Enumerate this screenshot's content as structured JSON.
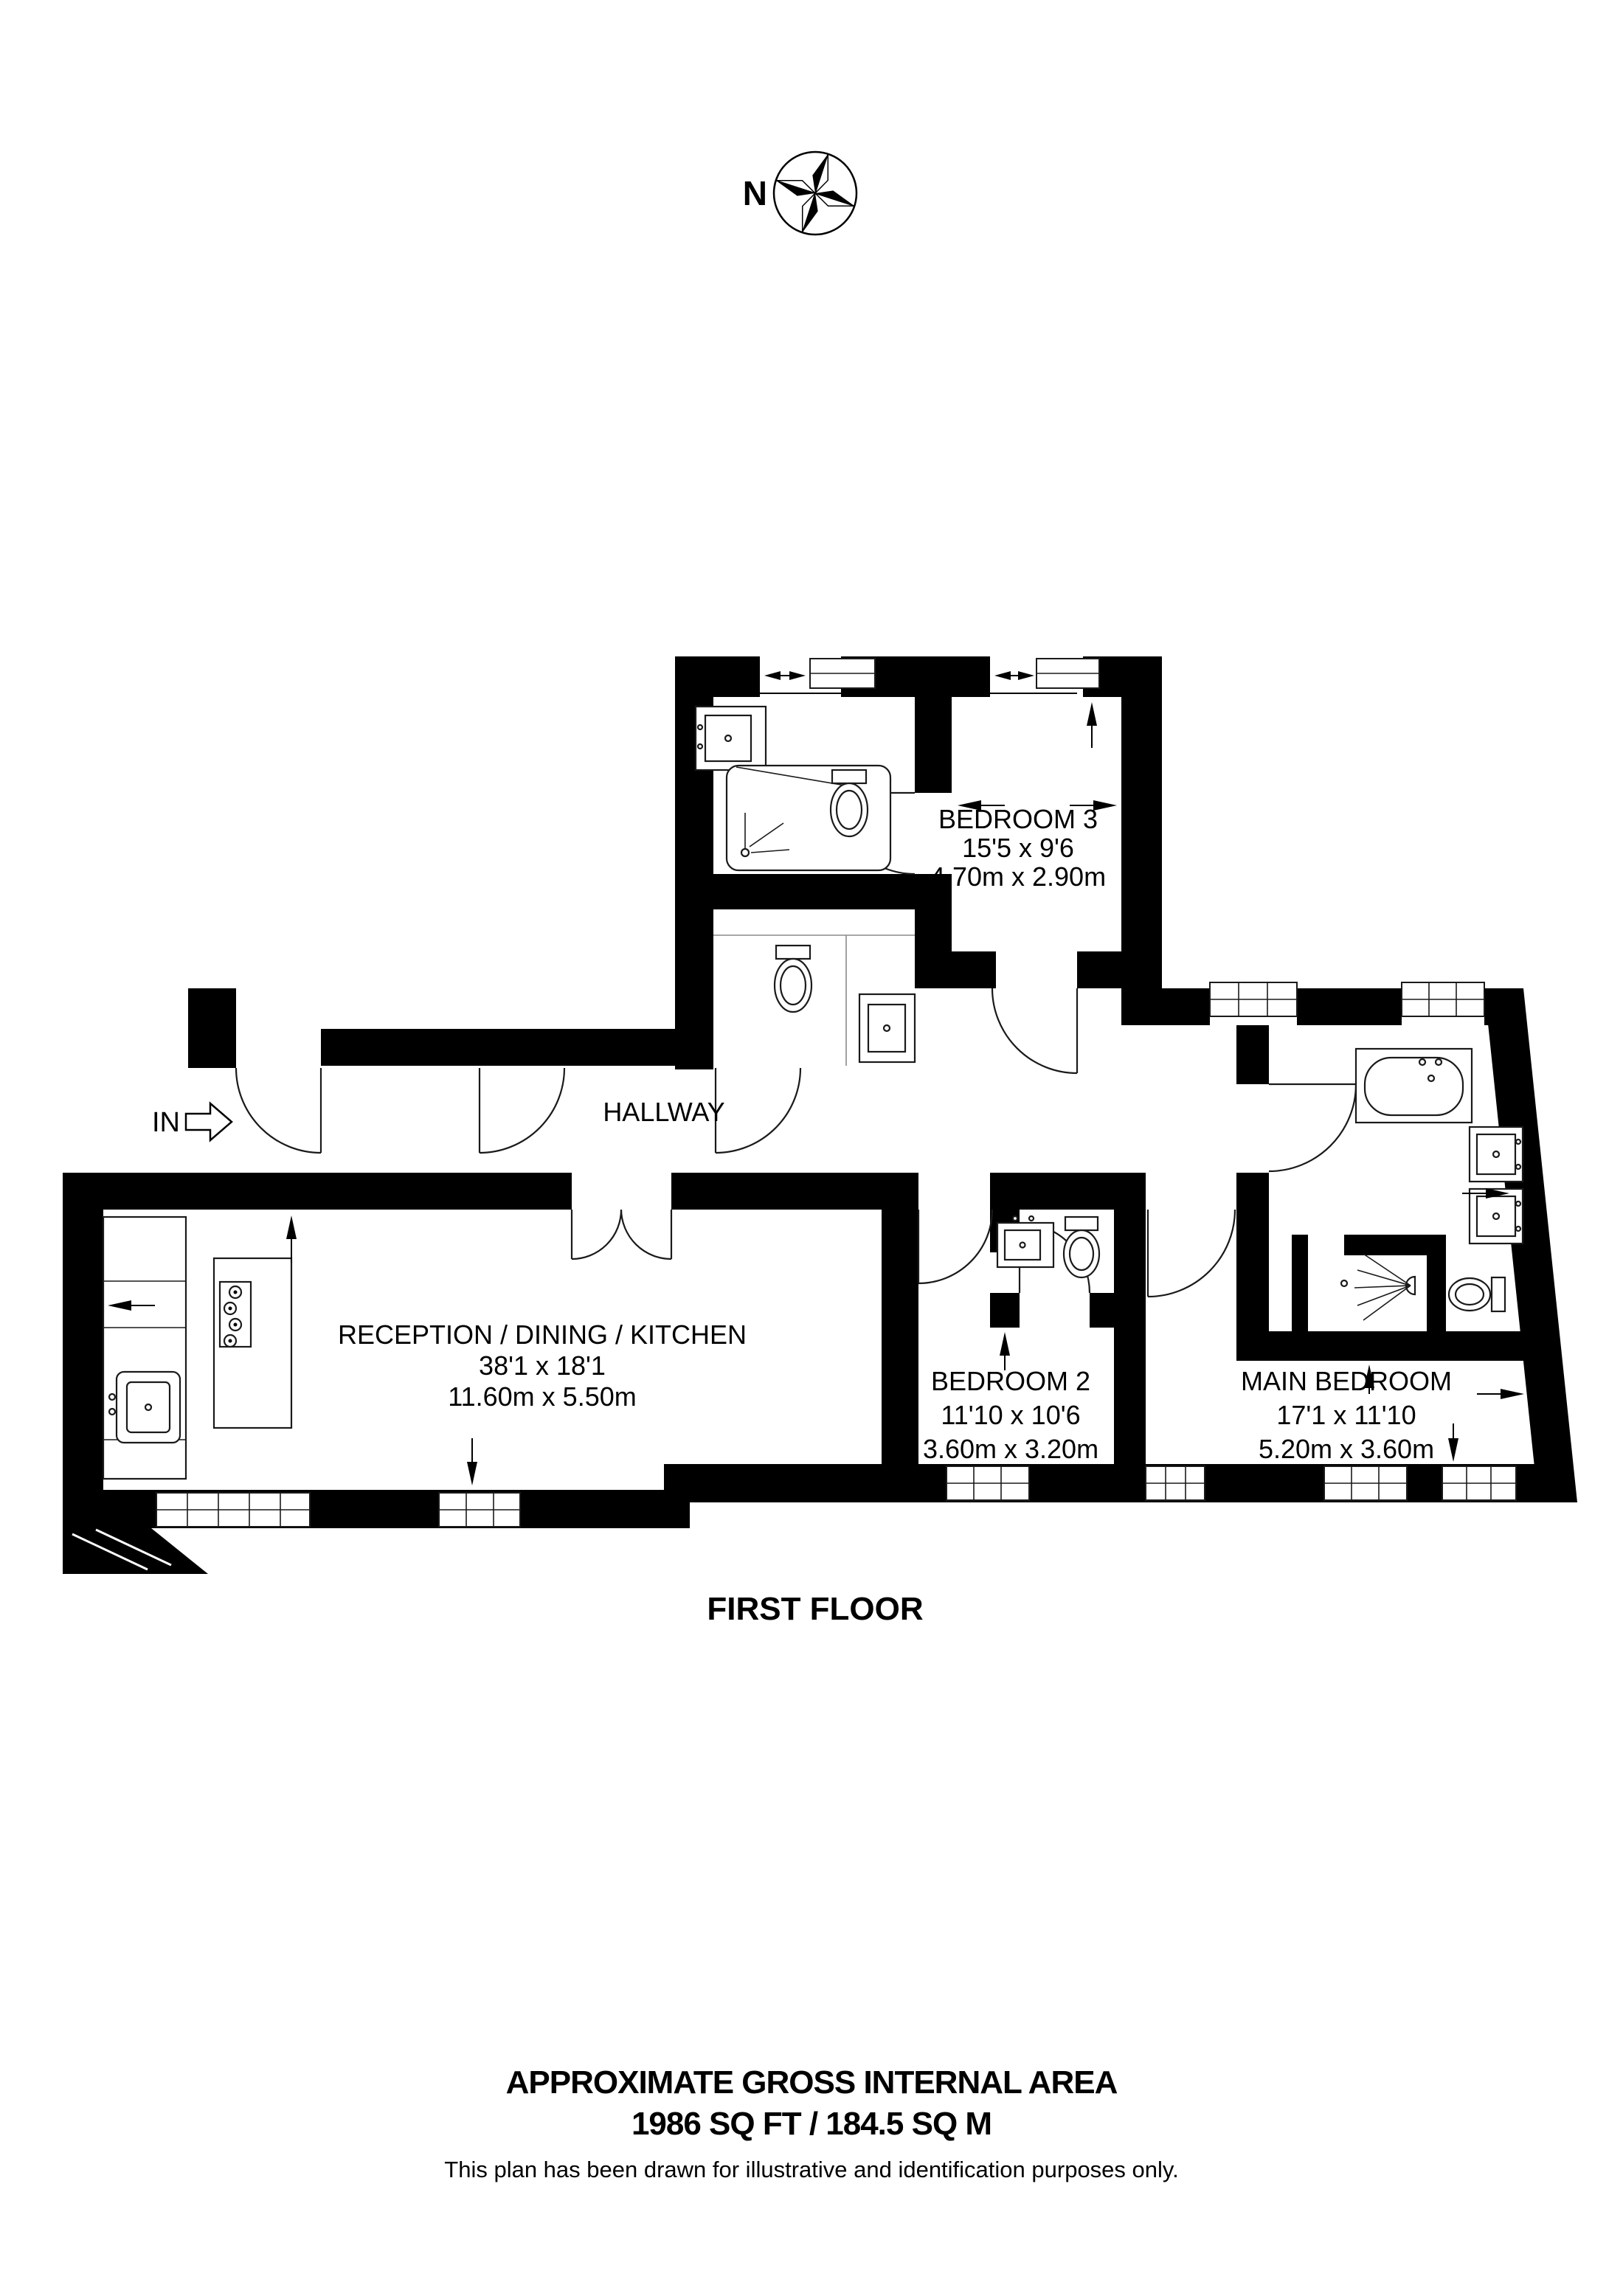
{
  "compass": {
    "north_label": "N"
  },
  "entry": {
    "label": "IN"
  },
  "rooms": {
    "bedroom3": {
      "name": "BEDROOM 3",
      "imperial": "15'5 x 9'6",
      "metric": "4.70m x 2.90m"
    },
    "hallway": {
      "name": "HALLWAY"
    },
    "reception": {
      "name": "RECEPTION / DINING / KITCHEN",
      "imperial": "38'1 x 18'1",
      "metric": "11.60m x 5.50m"
    },
    "bedroom2": {
      "name": "BEDROOM 2",
      "imperial": "11'10 x 10'6",
      "metric": "3.60m x 3.20m"
    },
    "main_bedroom": {
      "name": "MAIN BEDROOM",
      "imperial": "17'1 x 11'10",
      "metric": "5.20m x 3.60m"
    }
  },
  "floor_label": "FIRST FLOOR",
  "footer": {
    "line1": "APPROXIMATE GROSS INTERNAL AREA",
    "line2": "1986 SQ FT / 184.5 SQ M",
    "disclaimer": "This plan has been drawn for illustrative and identification purposes only."
  },
  "colors": {
    "wall": "#000000",
    "background": "#ffffff",
    "line": "#1a1a1a"
  }
}
